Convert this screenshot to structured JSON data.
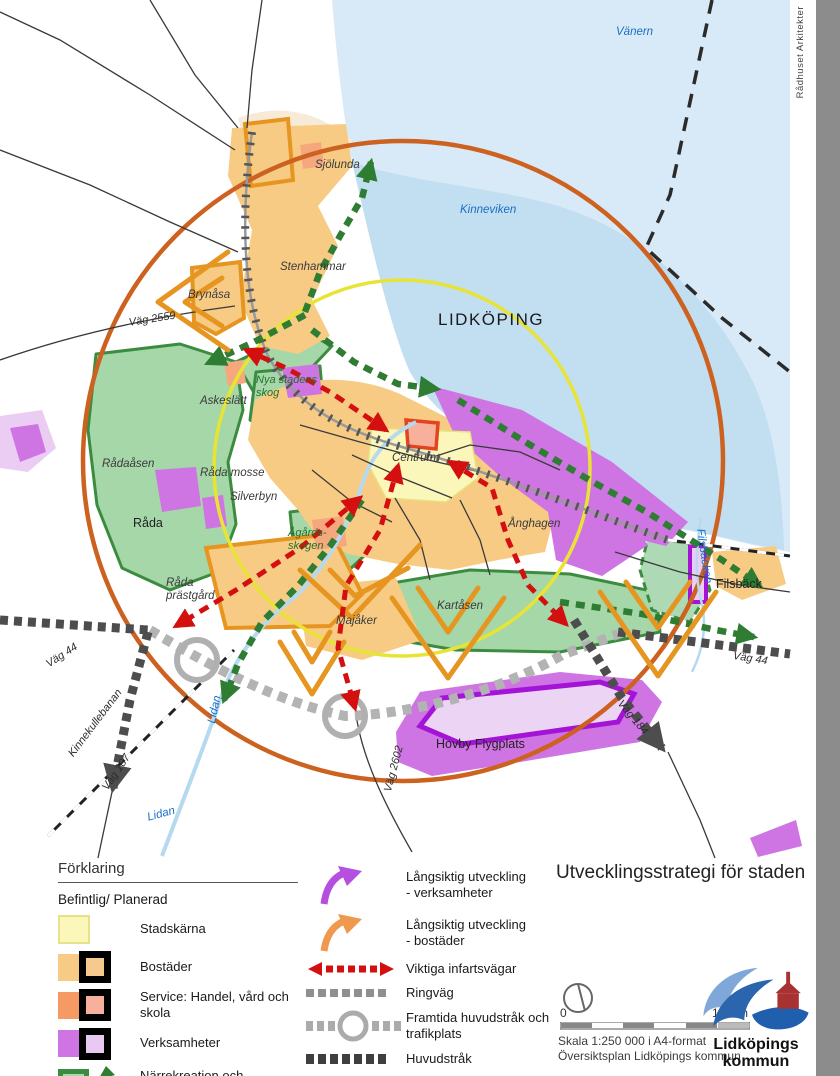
{
  "page": {
    "credit": "Rådhuset Arkitekter",
    "title": "Utvecklingsstrategi för staden"
  },
  "map": {
    "labels": [
      {
        "t": "Vänern",
        "x": 616,
        "y": 26,
        "c": "water"
      },
      {
        "t": "Kinneviken",
        "x": 460,
        "y": 204,
        "c": "water"
      },
      {
        "t": "LIDKÖPING",
        "x": 438,
        "y": 310,
        "c": "city"
      },
      {
        "t": "Sjölunda",
        "x": 315,
        "y": 159,
        "c": "place"
      },
      {
        "t": "Stenhammar",
        "x": 280,
        "y": 261,
        "c": "place"
      },
      {
        "t": "Brynåsa",
        "x": 188,
        "y": 289,
        "c": "place"
      },
      {
        "t": "Väg 2559",
        "x": 128,
        "y": 317,
        "c": "road",
        "r": -9
      },
      {
        "t": "Nya stadens\nskog",
        "x": 256,
        "y": 374,
        "c": "green"
      },
      {
        "t": "Askeslätt",
        "x": 200,
        "y": 395,
        "c": "place"
      },
      {
        "t": "Rådaåsen",
        "x": 102,
        "y": 458,
        "c": "place"
      },
      {
        "t": "Råda mosse",
        "x": 200,
        "y": 467,
        "c": "place"
      },
      {
        "t": "Silverbyn",
        "x": 230,
        "y": 491,
        "c": "place"
      },
      {
        "t": "Råda",
        "x": 133,
        "y": 516,
        "c": "town"
      },
      {
        "t": "Centrum",
        "x": 392,
        "y": 452,
        "c": "place"
      },
      {
        "t": "Ånghagen",
        "x": 508,
        "y": 518,
        "c": "place"
      },
      {
        "t": "Ågårds-\nskogen",
        "x": 288,
        "y": 527,
        "c": "green"
      },
      {
        "t": "Råda\nprästgård",
        "x": 166,
        "y": 577,
        "c": "place"
      },
      {
        "t": "Majåker",
        "x": 336,
        "y": 615,
        "c": "place"
      },
      {
        "t": "Kartåsen",
        "x": 437,
        "y": 600,
        "c": "place"
      },
      {
        "t": "Filsbäck",
        "x": 716,
        "y": 577,
        "c": "town"
      },
      {
        "t": "Väg 44",
        "x": 734,
        "y": 650,
        "c": "road",
        "r": 9
      },
      {
        "t": "Väg 44",
        "x": 44,
        "y": 660,
        "c": "road",
        "r": -33
      },
      {
        "t": "Kinnekullebanan",
        "x": 66,
        "y": 752,
        "c": "road",
        "r": -53
      },
      {
        "t": "Väg 187",
        "x": 100,
        "y": 786,
        "c": "road",
        "r": -56
      },
      {
        "t": "Lidan",
        "x": 146,
        "y": 812,
        "c": "water",
        "r": -15
      },
      {
        "t": "Lidan",
        "x": 206,
        "y": 722,
        "c": "water",
        "r": -78
      },
      {
        "t": "Väg 2602",
        "x": 382,
        "y": 790,
        "c": "road",
        "r": -75
      },
      {
        "t": "Väg 184",
        "x": 624,
        "y": 698,
        "c": "road",
        "r": 50
      },
      {
        "t": "Hovby Flygplats",
        "x": 436,
        "y": 737,
        "c": "town"
      },
      {
        "t": "Filsbäcken",
        "x": 706,
        "y": 528,
        "c": "water",
        "r": 82
      }
    ]
  },
  "legend": {
    "header": "Förklaring",
    "subheader": "Befintlig/ Planerad",
    "areas": [
      {
        "label": "Stadskärna"
      },
      {
        "label": "Bostäder"
      },
      {
        "label": "Service: Handel, vård och skola"
      },
      {
        "label": "Verksamheter"
      },
      {
        "label": "Närrekreation och\ngrönstråk"
      }
    ],
    "symbols": [
      {
        "label": "Långsiktig utveckling\n- verksamheter"
      },
      {
        "label": "Långsiktig utveckling\n- bostäder"
      },
      {
        "label": "Viktiga infartsvägar"
      },
      {
        "label": "Ringväg"
      },
      {
        "label": "Framtida huvudstråk och trafikplats"
      },
      {
        "label": "Huvudstråk"
      },
      {
        "label": "Gång- (3 km) och cykel-\navstånd (5 km) till centrum"
      }
    ]
  },
  "footer": {
    "north_zero": "0",
    "scale_label": "1,5 km",
    "scale_line1": "Skala 1:250 000 i A4-format",
    "scale_line2": "Översiktsplan Lidköpings kommun",
    "logo_line1": "Lidköpings",
    "logo_line2": "kommun"
  },
  "colors": {
    "water": "#d8e9f7",
    "bay": "#c2def1",
    "stadskarna": "#fbf7bb",
    "bostader": "#f8cb85",
    "bostader_planerad": "#e09420",
    "service": "#f59a62",
    "service_planerad": "#e3571f",
    "verksamheter": "#cf74e3",
    "verksamheter_planerad": "#a818d6",
    "gronstrak": "#a8d8ad",
    "gronstrak_border": "#3c8c40",
    "gronstrak_route": "#2e7d32",
    "infartsvagar": "#d40f0f",
    "ringvag": "#ababab",
    "huvudstrak": "#4d4d4d",
    "ring_5km": "#cd6120",
    "ring_3km": "#e8e435"
  }
}
